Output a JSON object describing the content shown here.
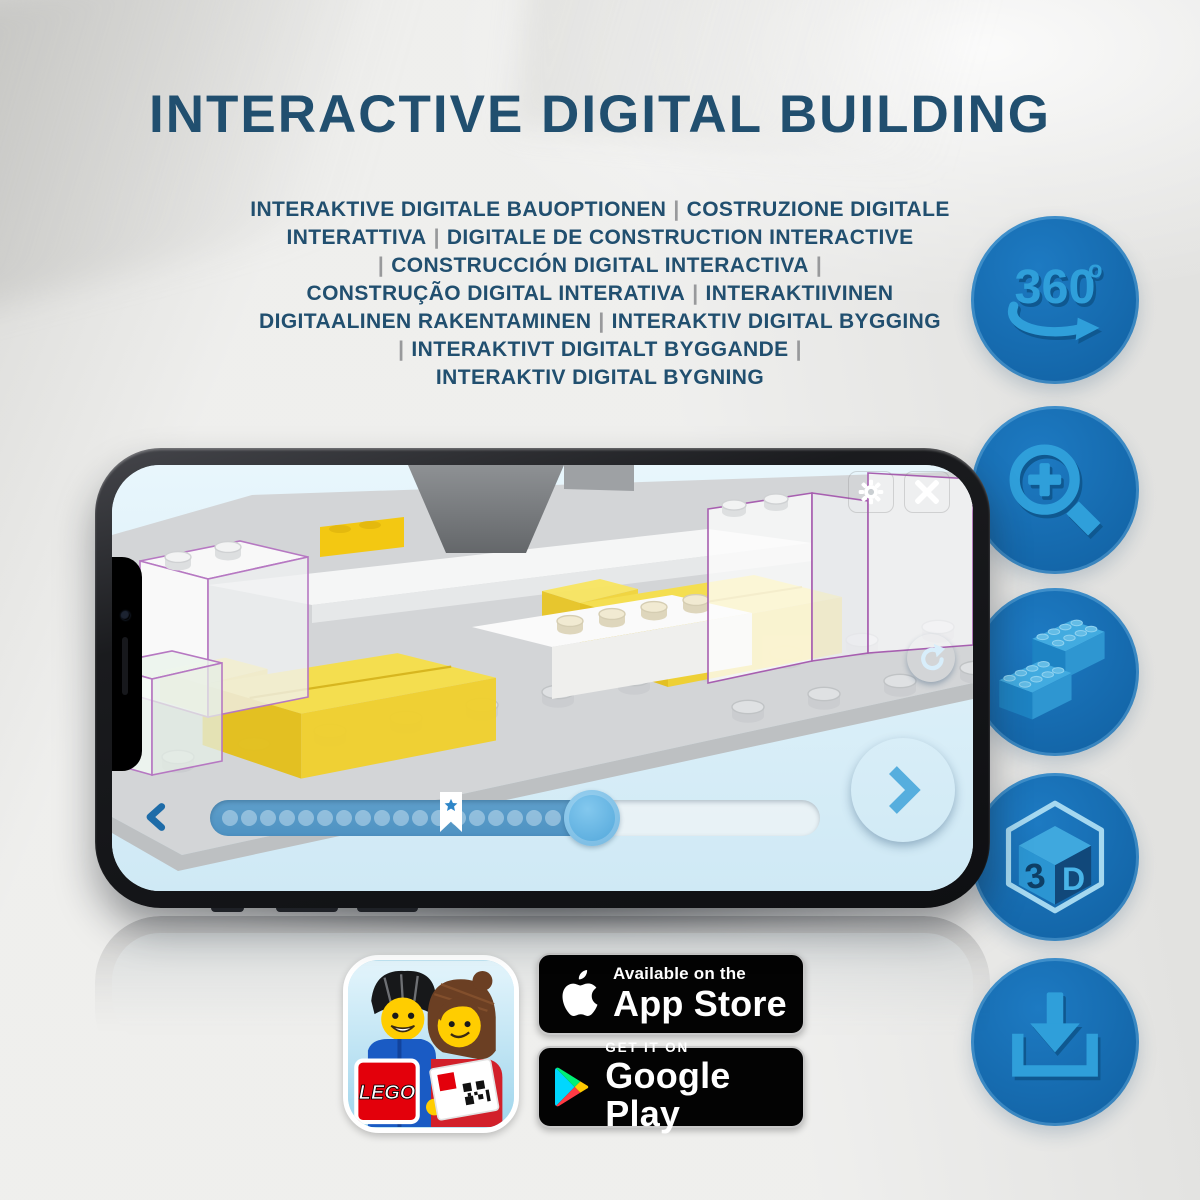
{
  "title": "INTERACTIVE DIGITAL BUILDING",
  "subtitle_lines": [
    "INTERAKTIVE DIGITALE BAUOPTIONEN | COSTRUZIONE DIGITALE",
    "INTERATTIVA | DIGITALE DE CONSTRUCTION INTERACTIVE",
    "| CONSTRUCCIÓN DIGITAL INTERACTIVA |",
    "CONSTRUÇÃO DIGITAL INTERATIVA | INTERAKTIIVINEN",
    "DIGITAALINEN RAKENTAMINEN | INTERAKTIV DIGITAL BYGGING",
    "| INTERAKTIVT DIGITALT BYGGANDE |",
    "INTERAKTIV DIGITAL BYGNING"
  ],
  "feature_icons": [
    {
      "name": "360-rotation",
      "label": "360",
      "degree": "o"
    },
    {
      "name": "zoom-in-magnifier"
    },
    {
      "name": "lego-bricks"
    },
    {
      "name": "3d-cube",
      "digit": "3",
      "letter": "D"
    },
    {
      "name": "download"
    }
  ],
  "phone_ui": {
    "top_buttons": [
      "settings-gear",
      "close-x"
    ],
    "side_controls": [
      "rotate-model"
    ],
    "nav_buttons": [
      "previous-step",
      "next-step"
    ],
    "slider": {
      "dot_count": 19,
      "marker": "star-bookmark"
    }
  },
  "badges": {
    "app_store": {
      "line1": "Available on the",
      "line2": "App Store"
    },
    "google_play": {
      "line1": "GET IT ON",
      "line2": "Google Play"
    },
    "lego_app": {
      "logo_text": "LEGO"
    }
  },
  "colors": {
    "title_blue": "#214F6F",
    "separator_gray": "#98999B",
    "circle_blue": "#1B71B7",
    "glyph_blue": "#2F9FDA",
    "screen_sky": "#DDEFFA",
    "bed_yellow": "#F2D73B",
    "outline_purple": "#A75FB0",
    "badge_black": "#030303"
  }
}
